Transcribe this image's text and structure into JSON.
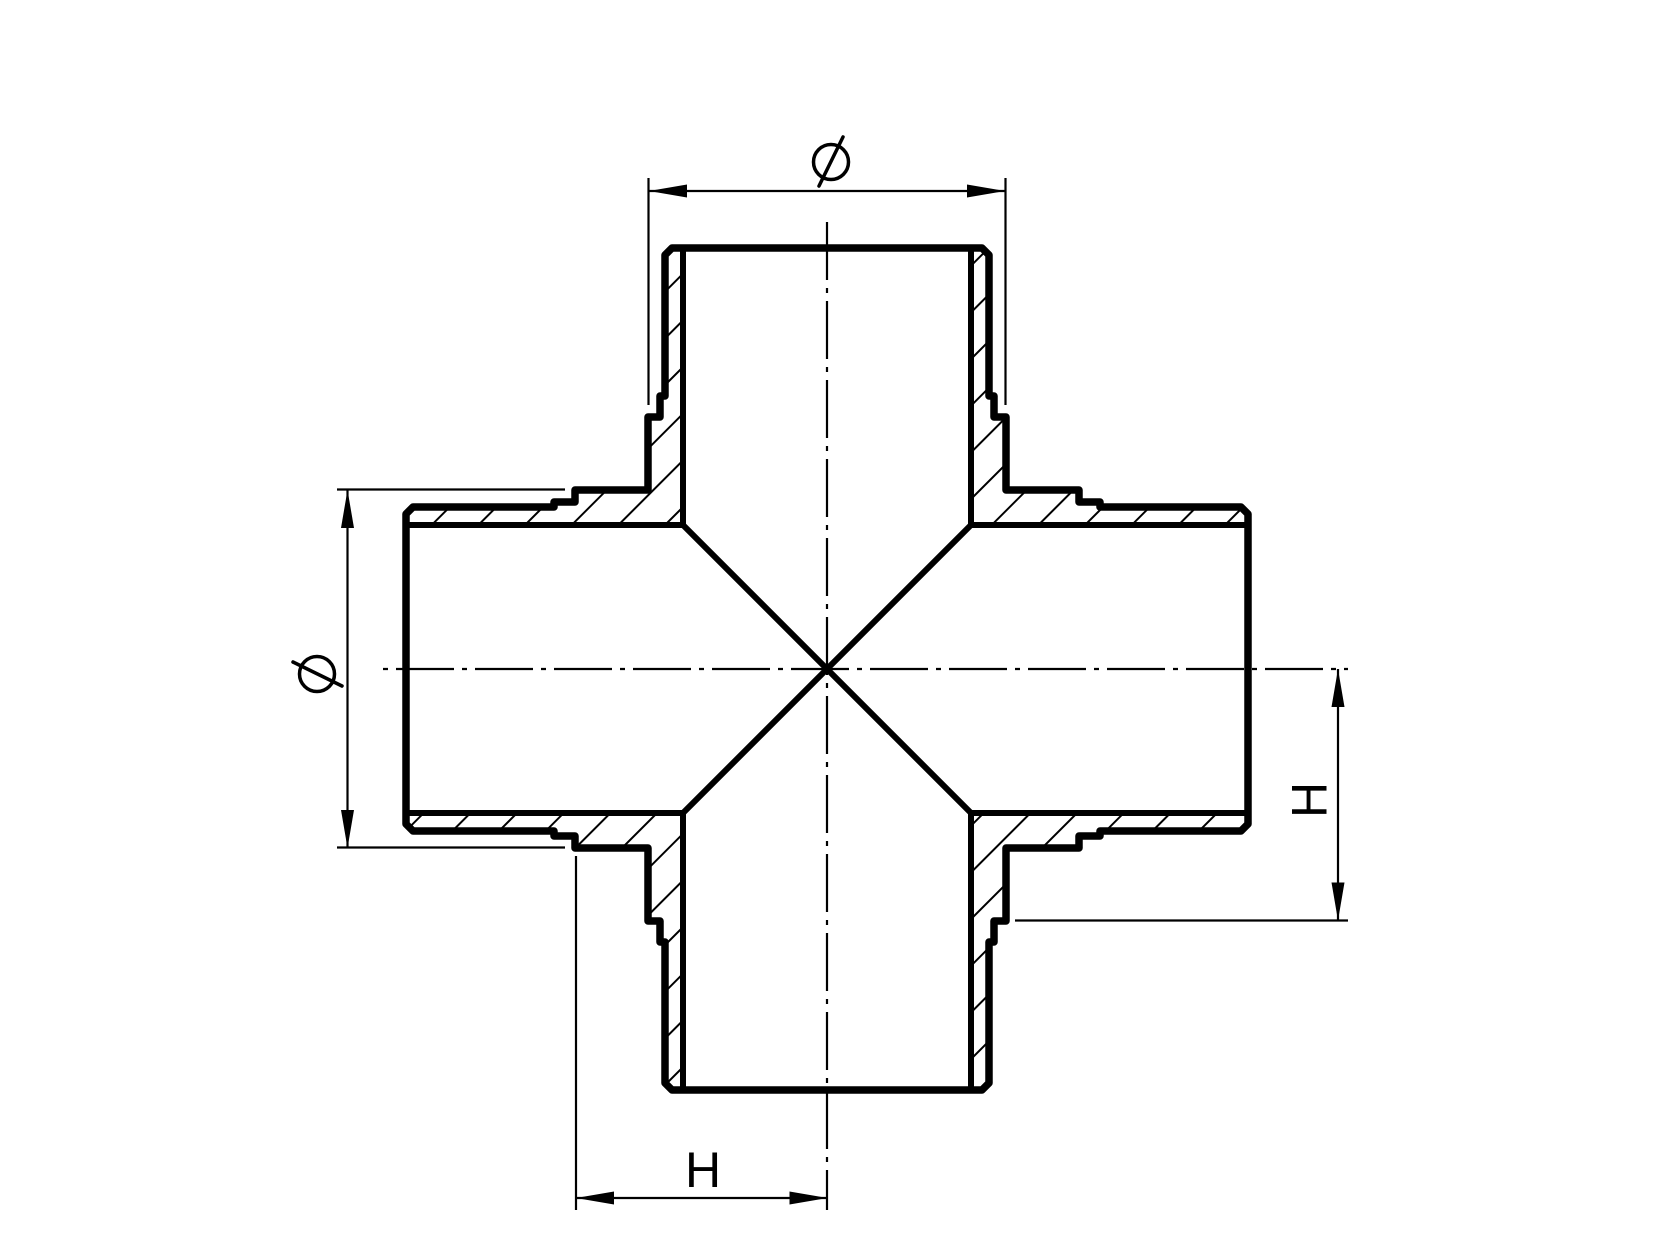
{
  "page": {
    "background_color": "#ffffff",
    "line_color": "#000000"
  },
  "drawing": {
    "type": "technical-drawing",
    "subject": "four-way equal cross pipe fitting, full section view with hatched walls",
    "labels": {
      "top_dimension": "Ø",
      "left_dimension": "Ø",
      "right_dimension": "H",
      "bottom_dimension": "H"
    }
  }
}
